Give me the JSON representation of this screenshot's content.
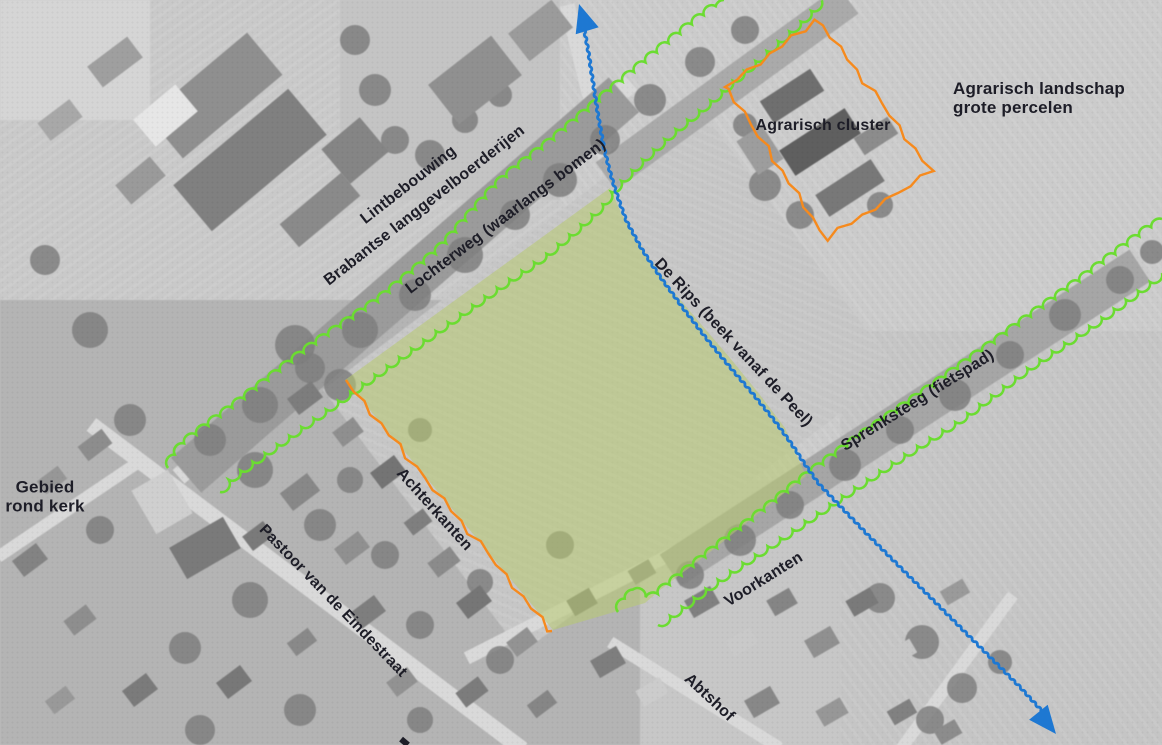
{
  "figure": {
    "kind": "annotated-aerial-map",
    "language": "nl"
  },
  "labels": {
    "lintbebouwing_line1": "Lintbebouwing",
    "lintbebouwing_line2": "Brabantse langgevelboerderijen",
    "lochterweg": "Lochterweg (waarlangs bomen)",
    "agrarisch_cluster": "Agrarisch cluster",
    "agrarisch_landschap_line1": "Agrarisch landschap",
    "agrarisch_landschap_line2": "grote percelen",
    "de_rips": "De Rips (beek vanaf de Peel)",
    "sprenksteeg": "Sprenksteeg (fietspad)",
    "gebied_line1": "Gebied",
    "gebied_line2": "rond kerk",
    "achterkanten": "Achterkanten",
    "pastoor": "Pastoor van de Eindestraat",
    "voorkanten": "Voorkanten",
    "abtshof": "Abtshof"
  },
  "annotations": {
    "tree_line_color": "#6bdc31",
    "stream_color": "#1e78d2",
    "boundary_color": "#f68a1d",
    "plan_area_fill": "rgba(184,202,112,0.55)",
    "label_color": "#1d1d27"
  }
}
